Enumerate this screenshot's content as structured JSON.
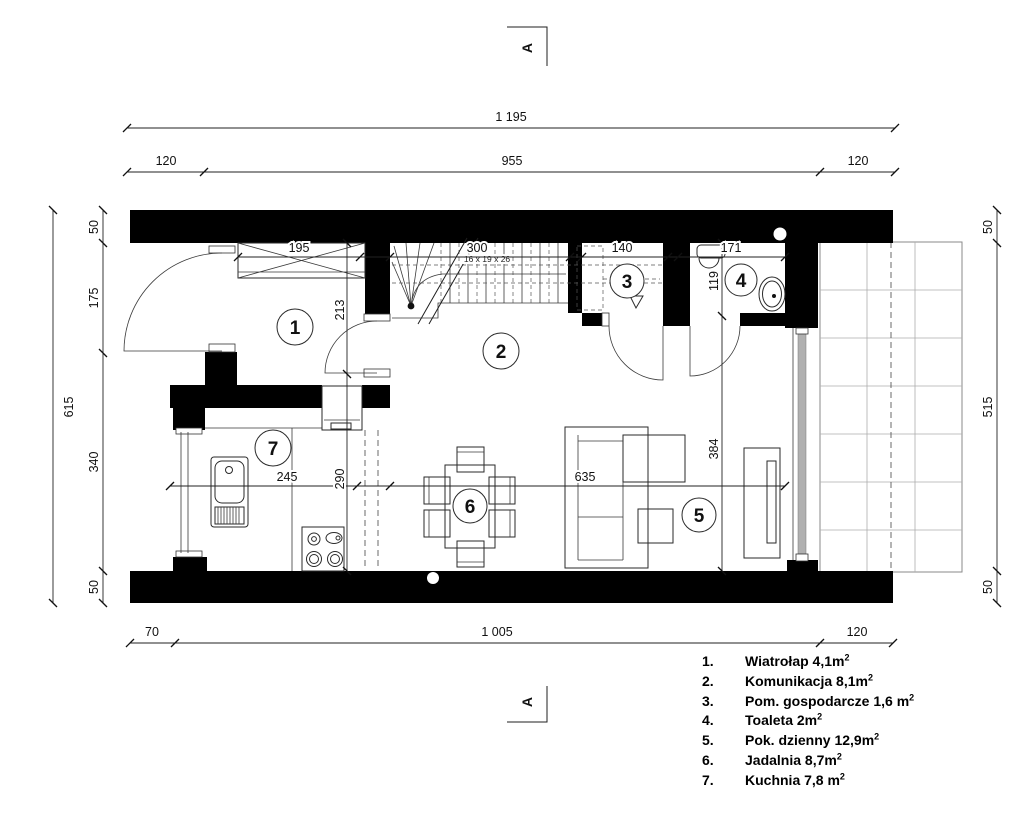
{
  "section_markers": {
    "top": "A",
    "bottom": "A"
  },
  "dimensions": {
    "total_width": "1 195",
    "top_chain": {
      "left": "120",
      "middle": "955",
      "right": "120"
    },
    "bottom_chain": {
      "left": "70",
      "middle": "1 005",
      "right": "120"
    },
    "left_total": "615",
    "left_chain": {
      "s1": "50",
      "s2": "175",
      "s3": "340",
      "s4": "50"
    },
    "right_chain": {
      "s1": "50",
      "s2": "515",
      "s3": "50"
    },
    "interior": {
      "wardrobe_w": "195",
      "stairs_w": "300",
      "storage_w": "140",
      "toilet_w": "171",
      "vestibule_h": "213",
      "toilet_h": "119",
      "kitchen_w": "245",
      "kitchen_h": "290",
      "living_w": "635",
      "living_h": "384"
    },
    "stairs_note": "16 x 19 x 26"
  },
  "rooms": {
    "r1": "1",
    "r2": "2",
    "r3": "3",
    "r4": "4",
    "r5": "5",
    "r6": "6",
    "r7": "7"
  },
  "legend": {
    "items": [
      {
        "num": "1.",
        "label": "Wiatrołap 4,1m",
        "sup": "2"
      },
      {
        "num": "2.",
        "label": "Komunikacja 8,1m",
        "sup": "2"
      },
      {
        "num": "3.",
        "label": "Pom. gospodarcze 1,6 m",
        "sup": "2"
      },
      {
        "num": "4.",
        "label": "Toaleta 2m",
        "sup": "2"
      },
      {
        "num": "5.",
        "label": "Pok. dzienny 12,9m",
        "sup": "2"
      },
      {
        "num": "6.",
        "label": "Jadalnia 8,7m",
        "sup": "2"
      },
      {
        "num": "7.",
        "label": "Kuchnia 7,8 m",
        "sup": "2"
      }
    ]
  },
  "colors": {
    "wall": "#000000",
    "line": "#1f1f1f",
    "grid": "#adadad",
    "glass": "#b0b0b0",
    "background": "#ffffff"
  }
}
